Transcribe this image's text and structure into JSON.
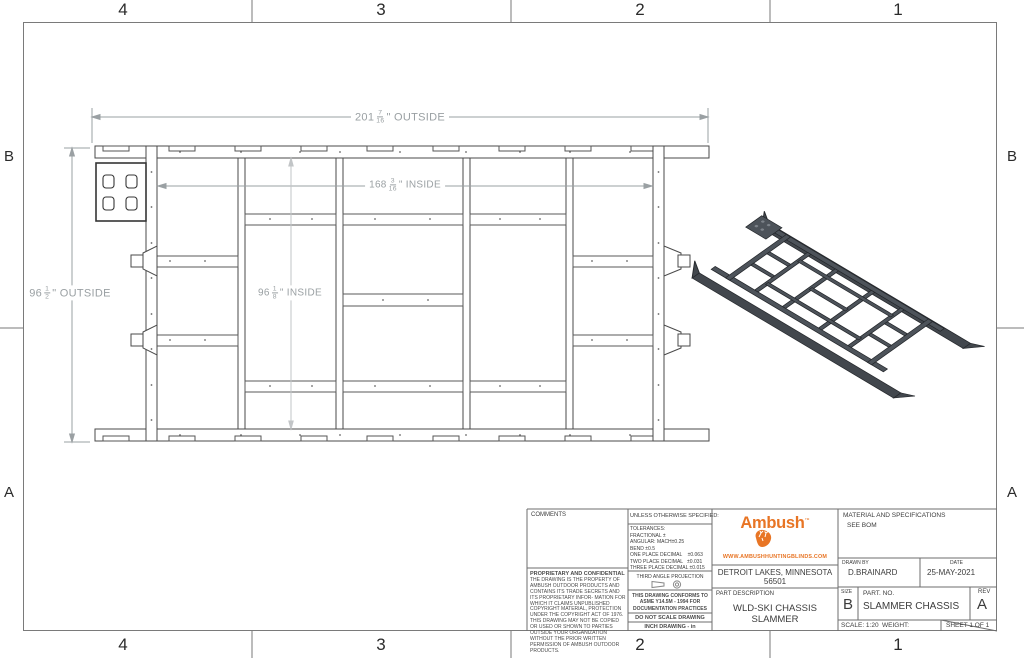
{
  "colors": {
    "accent_orange": "#E87525",
    "drawing_line": "#4a4a4a",
    "dimension_gray": "#9AA0A3",
    "iso_body": "#4D535A"
  },
  "zones": {
    "top": [
      "4",
      "3",
      "2",
      "1"
    ],
    "bottom": [
      "4",
      "3",
      "2",
      "1"
    ],
    "left": [
      "B",
      "A"
    ],
    "right": [
      "B",
      "A"
    ]
  },
  "dimensions": {
    "outside_width": {
      "whole": "201",
      "num": "7",
      "den": "16",
      "suffix": "\" OUTSIDE"
    },
    "inside_width": {
      "whole": "168",
      "num": "3",
      "den": "16",
      "suffix": "\" INSIDE"
    },
    "outside_height": {
      "whole": "96",
      "num": "1",
      "den": "2",
      "suffix": "\" OUTSIDE"
    },
    "inside_height": {
      "whole": "96",
      "num": "1",
      "den": "8",
      "suffix": "\" INSIDE"
    }
  },
  "title_block": {
    "comments_label": "COMMENTS",
    "proprietary": {
      "title": "PROPRIETARY AND CONFIDENTIAL",
      "body": "THE DRAWING IS THE PROPERTY OF AMBUSH OUTDOOR PRODUCTS AND CONTAINS ITS TRADE SECRETS AND ITS PROPRIETARY INFOR- MATION FOR WHICH IT CLAIMS UNPUBLISHED COPYRIGHT MATERIAL, PROTECTION UNDER THE COPYRIGHT ACT OF 1976. THIS DRAWING MAY NOT BE COPIED OR USED OR SHOWN TO PARTIES OUTSIDE YOUR ORGANIZATION WITHOUT THE PRIOR WRITTEN PERMISSION OF AMBUSH OUTDOOR PRODUCTS."
    },
    "specs": {
      "header": "UNLESS OTHERWISE SPECIFIED:",
      "lines": [
        "TOLERANCES:",
        "FRACTIONAL ±",
        "ANGULAR: MACH±0.25",
        "BEND ±0.5",
        "ONE PLACE DECIMAL    ±0.063",
        "TWO PLACE DECIMAL   ±0.031",
        "THREE PLACE DECIMAL ±0.015"
      ],
      "projection": "THIRD ANGLE PROJECTION",
      "conforms": "THIS DRAWING CONFORMS TO ASME Y14.5M - 1994 FOR DOCUMENTATION PRACTICES",
      "no_scale": "DO NOT SCALE DRAWING",
      "units": "INCH DRAWING - in"
    },
    "company": {
      "logo_text": "Ambush",
      "logo_tm": "™",
      "website": "WWW.AMBUSHHUNTINGBLINDS.COM",
      "address_line1": "DETROIT LAKES, MINNESOTA",
      "address_line2": "56501",
      "part_description_label": "PART DESCRIPTION",
      "part_description": "WLD-SKI CHASSIS SLAMMER"
    },
    "material": {
      "label": "MATERIAL AND SPECIFICATIONS",
      "value": "SEE BOM"
    },
    "drawn_by": {
      "label": "DRAWN BY",
      "value": "D.BRAINARD"
    },
    "date": {
      "label": "DATE",
      "value": "25-MAY-2021"
    },
    "size": {
      "label": "SIZE",
      "value": "B"
    },
    "part_no": {
      "label": "PART.  NO.",
      "value": "SLAMMER CHASSIS"
    },
    "rev": {
      "label": "REV",
      "value": "A"
    },
    "scale": {
      "label": "SCALE: 1:20",
      "weight_label": "WEIGHT:"
    },
    "sheet_label": "SHEET 1 OF 1"
  }
}
